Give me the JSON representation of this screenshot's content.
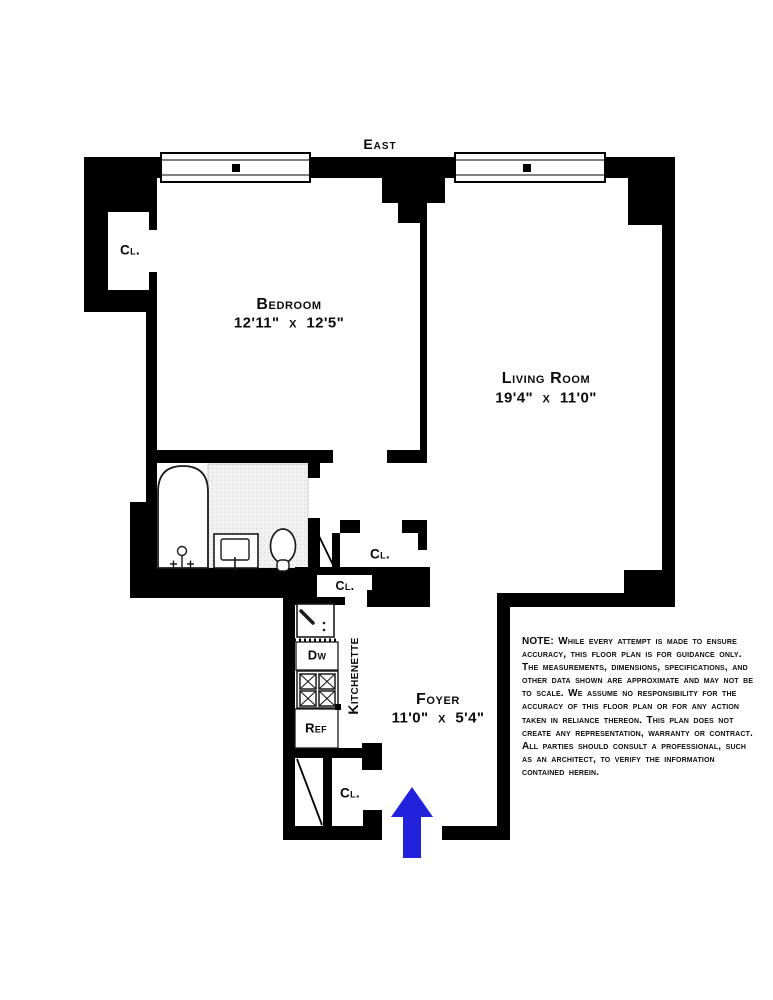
{
  "orientation": {
    "label": "East"
  },
  "rooms": {
    "bedroom": {
      "name": "Bedroom",
      "dimensions": "12'11\" x 12'5\""
    },
    "living_room": {
      "name": "Living Room",
      "dimensions": "19'4\" x 11'0\""
    },
    "foyer": {
      "name": "Foyer",
      "dimensions": "11'0\" x 5'4\""
    },
    "kitchenette": {
      "name": "Kitchenette"
    },
    "bathroom": {
      "fixtures": [
        "bathtub",
        "vanity-sink",
        "toilet",
        "tiled-floor"
      ]
    }
  },
  "closets": {
    "bedroom_closet": {
      "label": "Cl."
    },
    "hall_closet_upper": {
      "label": "Cl."
    },
    "hall_closet_lower": {
      "label": "Cl."
    },
    "entry_closet": {
      "label": "Cl."
    }
  },
  "appliances": {
    "dishwasher": {
      "label": "Dw"
    },
    "refrigerator": {
      "label": "Ref"
    },
    "stove_burners": 4,
    "kitchen_sink": "sink"
  },
  "entry": {
    "arrow": "entry-arrow-up"
  },
  "disclaimer": {
    "text": "NOTE: While every attempt is made to ensure accuracy, this floor plan is for guidance only. The measurements, dimensions, specifications, and other data shown are approximate and may not be to scale. We assume no responsibility for the accuracy of this floor plan or for any action taken in reliance thereon. This plan does not create any representation, warranty or contract. All parties should consult a professional, such as an architect, to verify the information contained herein."
  },
  "colors": {
    "wall": "#000000",
    "entry_arrow": "#2222dd",
    "bathroom_tile": "#f1f1f1",
    "background": "#ffffff"
  }
}
